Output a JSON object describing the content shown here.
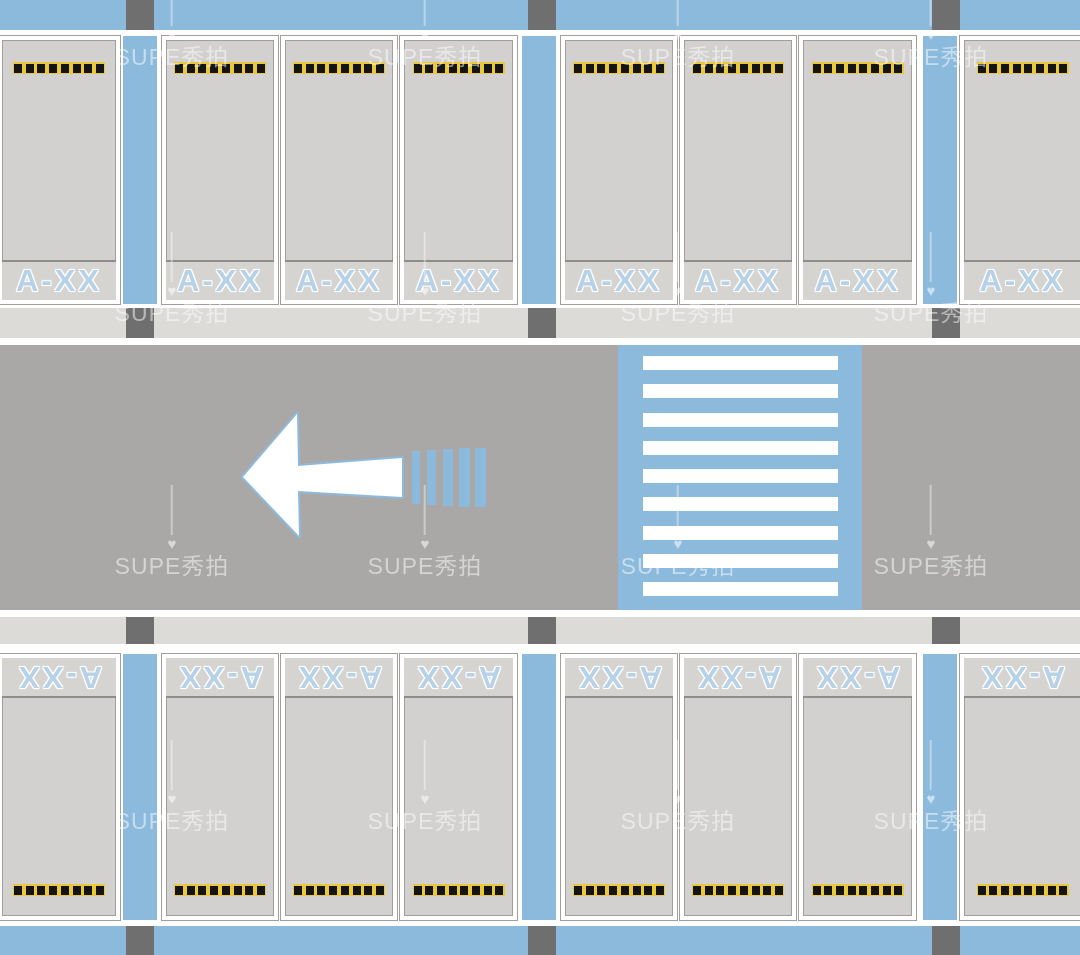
{
  "watermark": {
    "text": "SUPE秀拍"
  },
  "parking": {
    "hazard_square_count": 8,
    "top_row": {
      "stalls": [
        {
          "label": "A-XX"
        },
        {
          "label": "A-XX"
        },
        {
          "label": "A-XX"
        },
        {
          "label": "A-XX"
        },
        {
          "label": "A-XX"
        },
        {
          "label": "A-XX"
        },
        {
          "label": "A-XX"
        },
        {
          "label": "A-XX"
        }
      ]
    },
    "bottom_row": {
      "label_rotation_deg": 180,
      "stalls": [
        {
          "label": "A-XX"
        },
        {
          "label": "A-XX"
        },
        {
          "label": "A-XX"
        },
        {
          "label": "A-XX"
        },
        {
          "label": "A-XX"
        },
        {
          "label": "A-XX"
        },
        {
          "label": "A-XX"
        },
        {
          "label": "A-XX"
        }
      ]
    }
  },
  "road": {
    "arrow_direction": "left",
    "crosswalk": {
      "stripe_count": 9
    }
  },
  "colors": {
    "aisle_blue": "#8cbadd",
    "road_gray": "#a9a8a6",
    "stall_gray": "#d3d1cf",
    "label_band_gray": "#d6d4d1",
    "walkway_gray": "#dcdbd8",
    "column_gray": "#6f6f6f",
    "hazard_yellow": "#e9c83f",
    "hazard_black": "#141414",
    "marking_white": "#ffffff",
    "label_text_blue": "#b7d1e7"
  }
}
